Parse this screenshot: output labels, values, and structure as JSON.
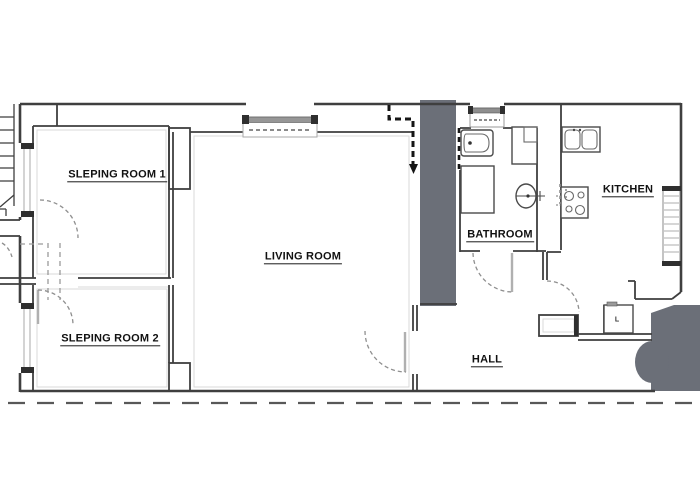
{
  "document": {
    "type": "apartment-floor-plan"
  },
  "rooms": {
    "sleeping1": {
      "label": "SLEPING ROOM 1"
    },
    "sleeping2": {
      "label": "SLEPING ROOM 2"
    },
    "living": {
      "label": "LIVING ROOM"
    },
    "bathroom": {
      "label": "BATHROOM"
    },
    "kitchen": {
      "label": "KITCHEN"
    },
    "hall": {
      "label": "HALL"
    }
  },
  "annotations": {
    "boiler_label": "L"
  },
  "fixtures": [
    "bathtub",
    "shower-tray",
    "storage-unit",
    "washbasin",
    "double-sink",
    "stove-4-burner",
    "boiler"
  ],
  "colors": {
    "wall": "#3f3f3f",
    "wall_light": "#c9c9c9",
    "solid_fill": "#6b6f78",
    "dash_bold": "#161616",
    "background": "#ffffff"
  }
}
